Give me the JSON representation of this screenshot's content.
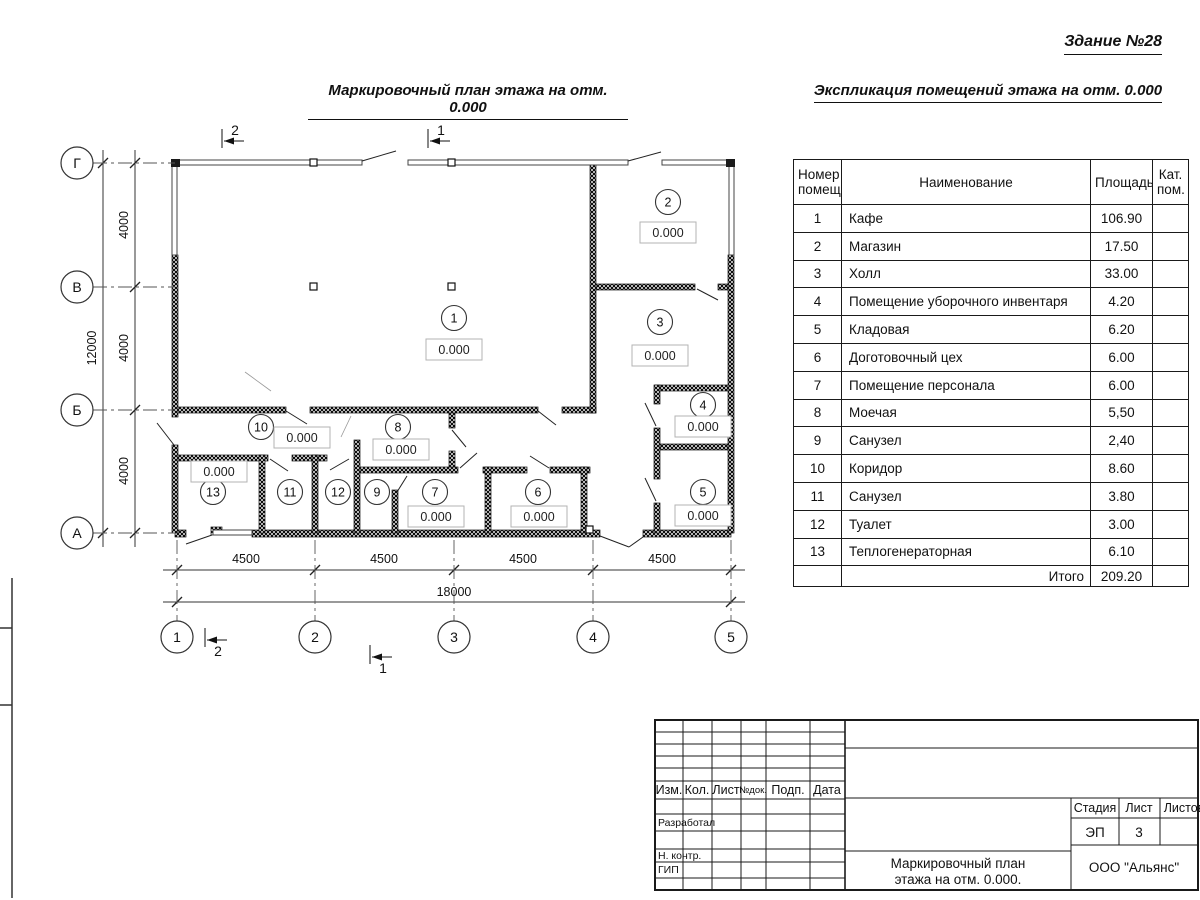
{
  "titles": {
    "building": "Здание №28",
    "plan": "Маркировочный план этажа на отм. 0.000",
    "explication": "Экспликация помещений этажа на отм. 0.000"
  },
  "plan": {
    "elevation": "0.000",
    "axes_letters": [
      {
        "label": "Г",
        "y": 163
      },
      {
        "label": "В",
        "y": 287
      },
      {
        "label": "Б",
        "y": 410
      },
      {
        "label": "А",
        "y": 533
      }
    ],
    "axes_numbers": [
      {
        "label": "1",
        "x": 177
      },
      {
        "label": "2",
        "x": 315
      },
      {
        "label": "3",
        "x": 454
      },
      {
        "label": "4",
        "x": 593
      },
      {
        "label": "5",
        "x": 731
      }
    ],
    "dims_bottom": [
      {
        "text": "4500",
        "x": 246
      },
      {
        "text": "4500",
        "x": 384
      },
      {
        "text": "4500",
        "x": 523
      },
      {
        "text": "4500",
        "x": 662
      }
    ],
    "dim_bottom_total": {
      "text": "18000",
      "x": 454,
      "y": 596
    },
    "dims_left": [
      {
        "text": "4000",
        "y": 225
      },
      {
        "text": "4000",
        "y": 348
      },
      {
        "text": "4000",
        "y": 471
      }
    ],
    "dim_left_total": {
      "text": "12000",
      "x": 96,
      "y": 348
    },
    "section_markers": [
      {
        "text": "2",
        "x": 222,
        "y": 141,
        "label_dy": -6
      },
      {
        "text": "1",
        "x": 428,
        "y": 141,
        "label_dy": -6
      },
      {
        "text": "2",
        "x": 205,
        "y": 640,
        "label_dy": 16
      },
      {
        "text": "1",
        "x": 370,
        "y": 657,
        "label_dy": 16
      }
    ],
    "rooms": [
      {
        "number": "1",
        "cx": 454,
        "cy": 318,
        "elevation": "0.000",
        "ex": 454,
        "ey": 350
      },
      {
        "number": "2",
        "cx": 668,
        "cy": 202,
        "elevation": "0.000",
        "ex": 668,
        "ey": 233
      },
      {
        "number": "3",
        "cx": 660,
        "cy": 322,
        "elevation": "0.000",
        "ex": 660,
        "ey": 356
      },
      {
        "number": "4",
        "cx": 703,
        "cy": 405,
        "elevation": "0.000",
        "ex": 703,
        "ey": 427
      },
      {
        "number": "5",
        "cx": 703,
        "cy": 492,
        "elevation": "0.000",
        "ex": 703,
        "ey": 516
      },
      {
        "number": "6",
        "cx": 538,
        "cy": 492,
        "elevation": "0.000",
        "ex": 539,
        "ey": 517
      },
      {
        "number": "7",
        "cx": 435,
        "cy": 492,
        "elevation": "0.000",
        "ex": 436,
        "ey": 517
      },
      {
        "number": "8",
        "cx": 398,
        "cy": 427,
        "elevation": "0.000",
        "ex": 401,
        "ey": 450
      },
      {
        "number": "9",
        "cx": 377,
        "cy": 492
      },
      {
        "number": "10",
        "cx": 261,
        "cy": 427,
        "elevation": "0.000",
        "ex": 302,
        "ey": 438
      },
      {
        "number": "11",
        "cx": 290,
        "cy": 492
      },
      {
        "number": "12",
        "cx": 338,
        "cy": 492
      },
      {
        "number": "13",
        "cx": 213,
        "cy": 492,
        "elevation": "0.000",
        "ex": 219,
        "ey": 472
      }
    ]
  },
  "table": {
    "headers": [
      "Номер помещ.",
      "Наименование",
      "Площадь",
      "Кат. пом."
    ],
    "rows": [
      [
        "1",
        "Кафе",
        "106.90"
      ],
      [
        "2",
        "Магазин",
        "17.50"
      ],
      [
        "3",
        "Холл",
        "33.00"
      ],
      [
        "4",
        "Помещение уборочного инвентаря",
        "4.20"
      ],
      [
        "5",
        "Кладовая",
        "6.20"
      ],
      [
        "6",
        "Доготовочный цех",
        "6.00"
      ],
      [
        "7",
        "Помещение персонала",
        "6.00"
      ],
      [
        "8",
        "Моечая",
        "5,50"
      ],
      [
        "9",
        "Санузел",
        "2,40"
      ],
      [
        "10",
        "Коридор",
        "8.60"
      ],
      [
        "11",
        "Санузел",
        "3.80"
      ],
      [
        "12",
        "Туалет",
        "3.00"
      ],
      [
        "13",
        "Теплогенераторная",
        "6.10"
      ]
    ],
    "total_label": "Итого",
    "total_value": "209.20"
  },
  "title_block": {
    "header_cells": [
      "Изм.",
      "Кол.",
      "Лист",
      "№док.",
      "Подп.",
      "Дата"
    ],
    "role_rows": [
      "Разработал",
      "Н. контр.",
      "ГИП"
    ],
    "stage_label": "Стадия",
    "sheet_label": "Лист",
    "sheets_label": "Листов",
    "stage_value": "ЭП",
    "sheet_value": "3",
    "doc_title_line1": "Маркировочный план",
    "doc_title_line2": "этажа на отм. 0.000.",
    "company": "ООО \"Альянс\""
  }
}
